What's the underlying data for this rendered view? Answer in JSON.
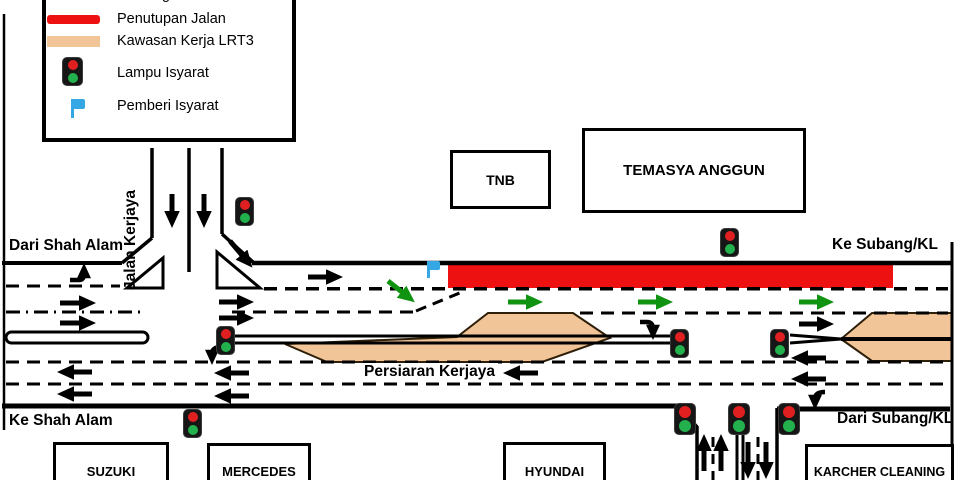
{
  "legend": {
    "clipped_fragment": "g",
    "items": [
      {
        "label": "Penutupan Jalan",
        "symbol": "road-closure-red-bar"
      },
      {
        "label": "Kawasan Kerja LRT3",
        "symbol": "lrt3-work-area-tan-bar"
      },
      {
        "label": "Lampu Isyarat",
        "symbol": "traffic-light"
      },
      {
        "label": "Pemberi Isyarat",
        "symbol": "blue-flag"
      }
    ]
  },
  "buildings": {
    "tnb": "TNB",
    "temasya_anggun": "TEMASYA ANGGUN",
    "suzuki": "SUZUKI",
    "mercedes": "MERCEDES",
    "hyundai": "HYUNDAI",
    "karcher": "KARCHER CLEANING"
  },
  "road_labels": {
    "from_shah_alam": "Dari Shah Alam",
    "to_subang_kl": "Ke Subang/KL",
    "to_shah_alam": "Ke Shah Alam",
    "from_subang_kl": "Dari Subang/KL",
    "jalan_kerjaya": "Jalan Kerjaya",
    "persiaran_kerjaya": "Persiaran Kerjaya"
  },
  "colors": {
    "closure_red": "#EE1111",
    "work_area_tan": "#F2C599",
    "diversion_green": "#109310",
    "flag_blue": "#35A7E5",
    "signal_red": "#E02020",
    "signal_green": "#22B14C"
  }
}
